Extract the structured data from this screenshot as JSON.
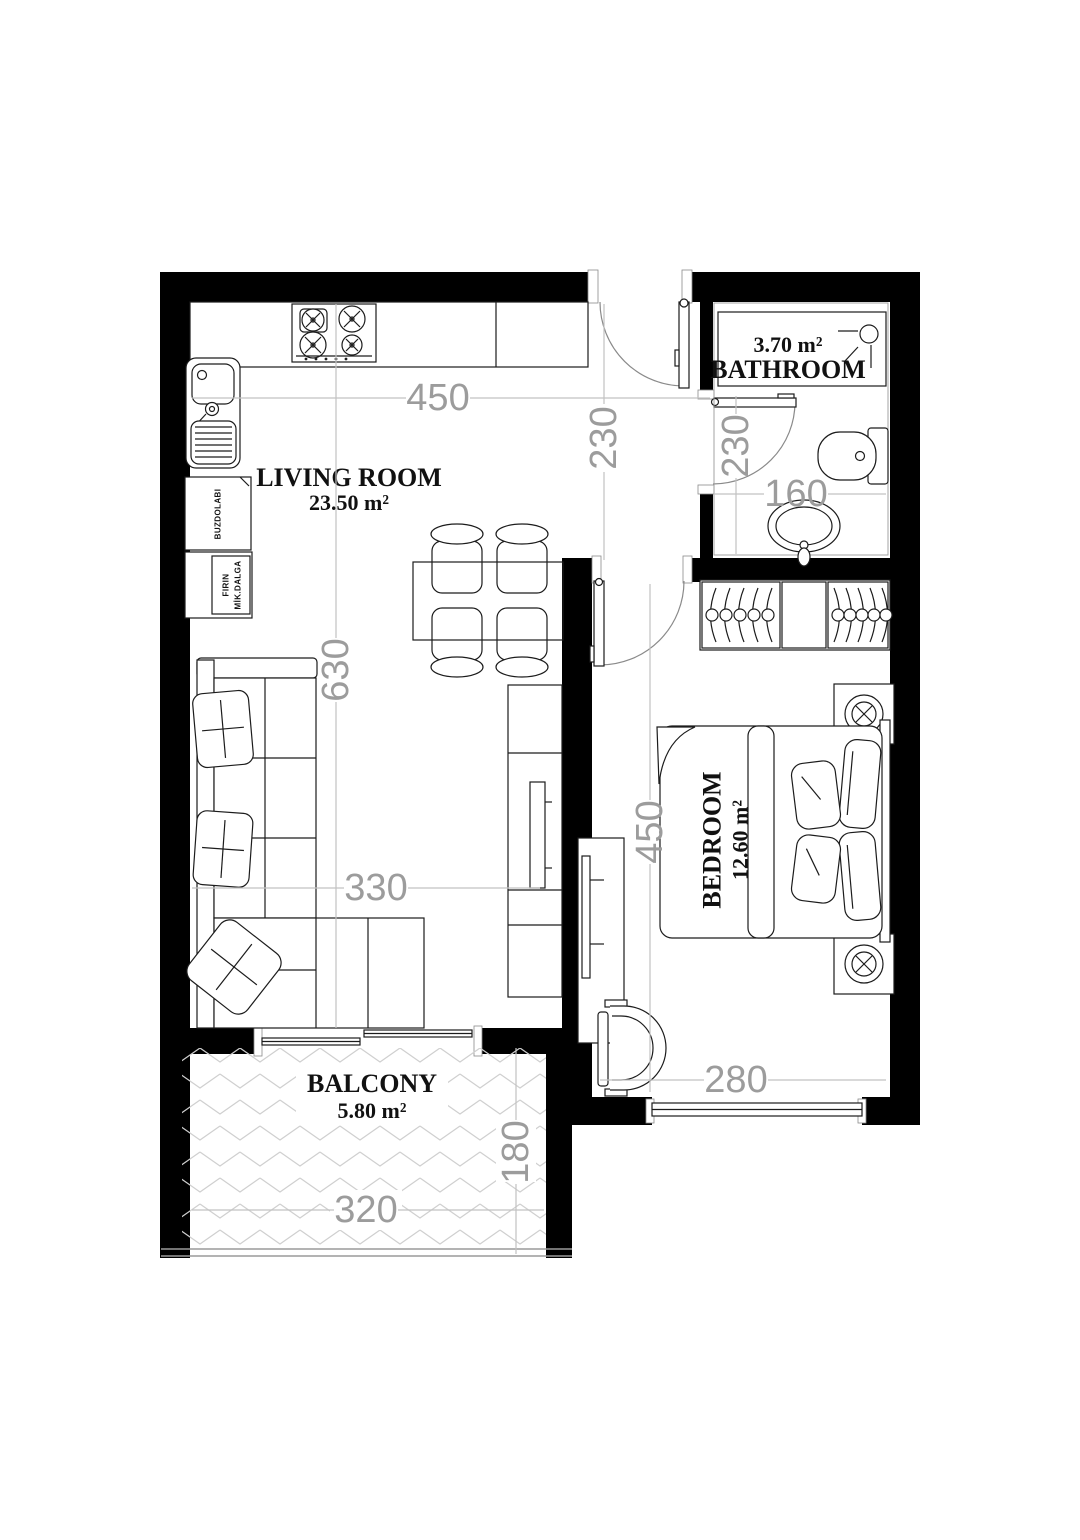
{
  "plan": {
    "rooms": {
      "living": {
        "name": "LIVING ROOM",
        "area": "23.50 m²"
      },
      "bathroom": {
        "name": "BATHROOM",
        "area": "3.70 m²"
      },
      "bedroom": {
        "name": "BEDROOM",
        "area": "12.60 m²"
      },
      "balcony": {
        "name": "BALCONY",
        "area": "5.80 m²"
      }
    },
    "dims": {
      "living_width": "450",
      "hall_depth": "230",
      "bath_door": "230",
      "bath_width": "160",
      "living_depth": "630",
      "sofa_span": "330",
      "bedroom_depth": "450",
      "bedroom_width": "280",
      "balcony_depth": "180",
      "balcony_width": "320"
    },
    "labels": {
      "fridge": "BUZDOLABI",
      "oven_line1": "FIRIN",
      "oven_line2": "MİK.DALGA"
    },
    "colors": {
      "wall": "#000000",
      "line": "#1c1c1c",
      "dim_text": "#9c9c9c",
      "dim_line": "#c2c2c2",
      "hatch": "#cfcfcf",
      "bg": "#ffffff"
    }
  }
}
